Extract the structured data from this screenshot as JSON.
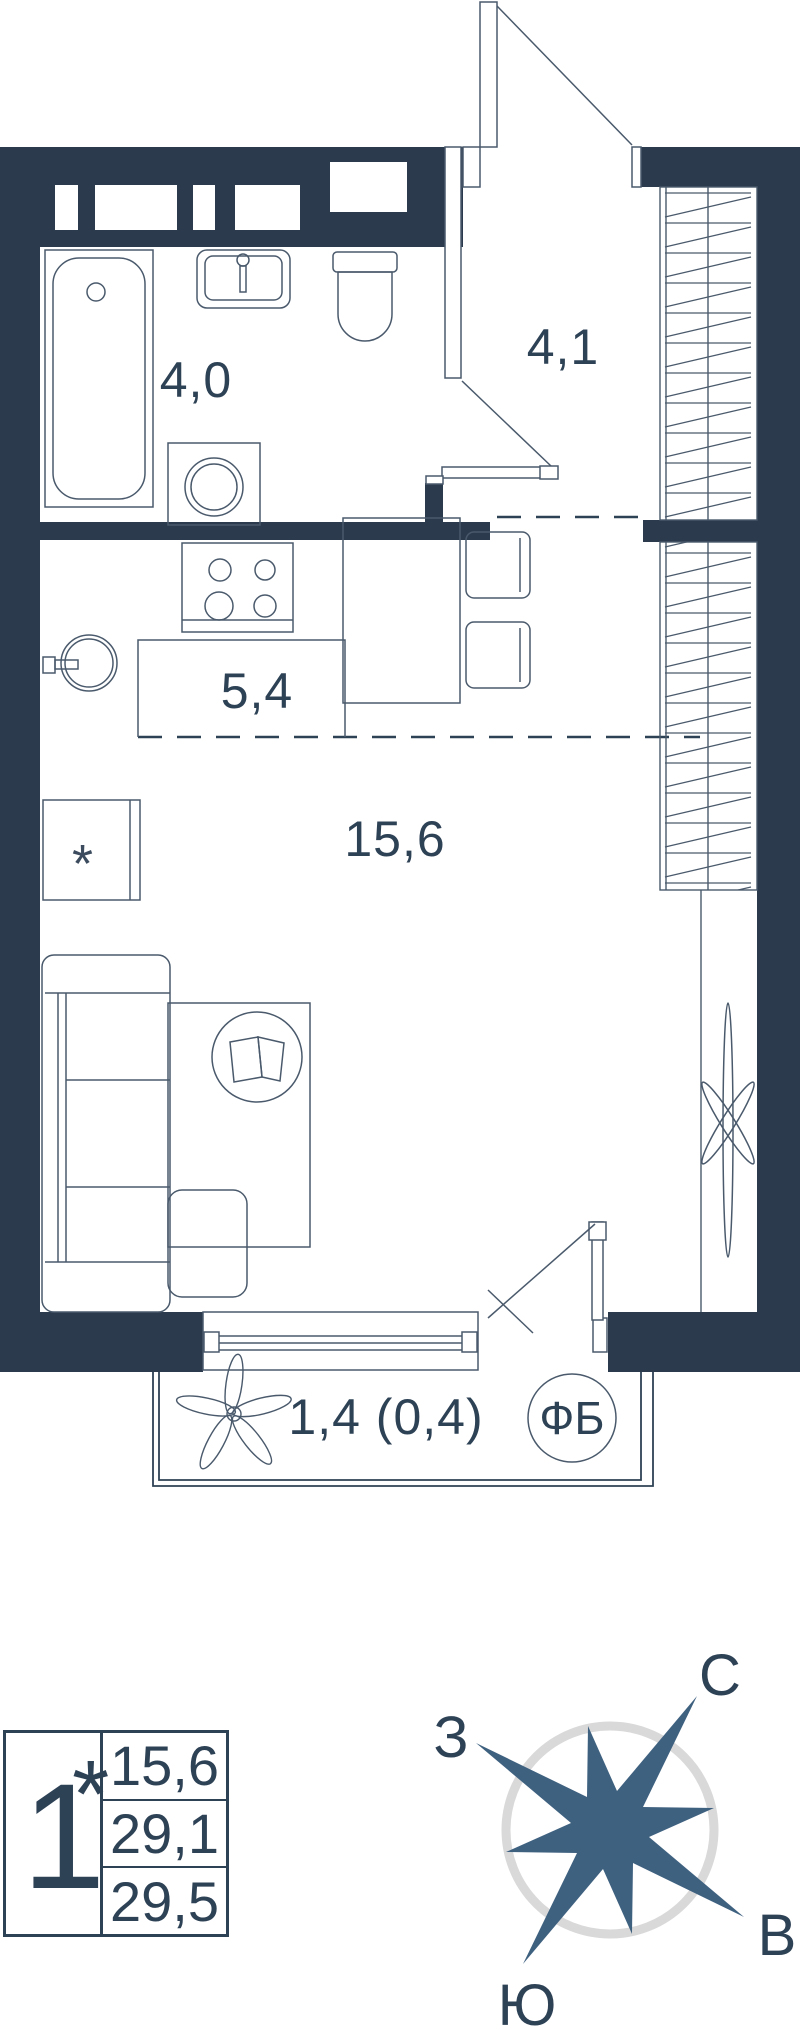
{
  "plan": {
    "rooms": [
      {
        "id": "bathroom",
        "area_label": "4,0"
      },
      {
        "id": "hallway",
        "area_label": "4,1"
      },
      {
        "id": "kitchen",
        "area_label": "5,4"
      },
      {
        "id": "living-room",
        "area_label": "15,6"
      },
      {
        "id": "balcony",
        "area_label": "1,4 (0,4)"
      }
    ],
    "balcony_tag": "ФБ",
    "fridge_symbol": "*"
  },
  "legend": {
    "unit_digit": "1",
    "unit_star": "*",
    "living_area": "15,6",
    "area_without_balcony": "29,1",
    "total_area": "29,5"
  },
  "compass": {
    "north": "С",
    "west": "З",
    "east": "В",
    "south": "Ю"
  },
  "colors": {
    "wall": "#2b3b4d",
    "furniture_line": "#4a5a6c",
    "text": "#2e4256",
    "star": "#3f6180",
    "compass_ring": "#d9d9d9",
    "background": "#ffffff"
  }
}
